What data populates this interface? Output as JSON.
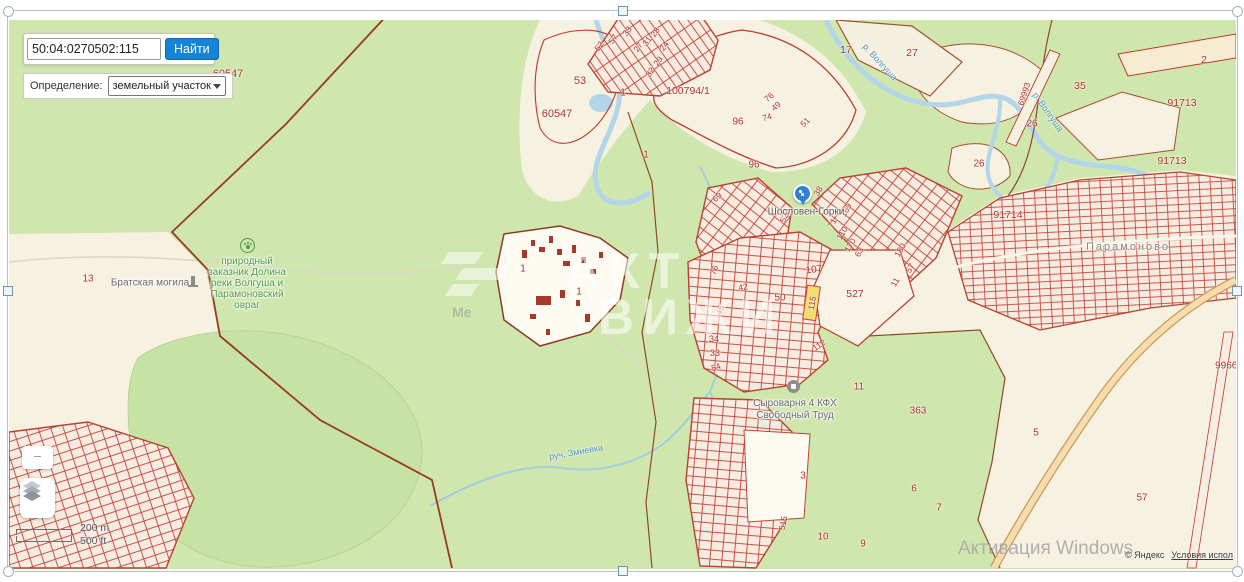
{
  "colors": {
    "accent_blue": "#1583d6",
    "parcel_red": "#b03227",
    "highlight_yellow": "#f1de6e",
    "map_green": "#cfe7ad"
  },
  "search_panel": {
    "query": "50:04:0270502:115",
    "find_button": "Найти",
    "definition_label": "Определение:",
    "definition_value": "земельный участок"
  },
  "map": {
    "watermark": {
      "line1": "АКТ",
      "line2": "ВИЖИ",
      "logo_text": "Ме"
    },
    "windows_activation": "Активация Windows",
    "attribution": "© Яндекс",
    "terms": "Условия испол",
    "scale": {
      "metric": "200 m",
      "imperial": "500 ft"
    },
    "highlight_label": "115",
    "poi": {
      "reserve": {
        "lines": [
          "природный",
          "заказник Долина",
          "реки Волгуша и",
          "Парамоновский",
          "овраг"
        ]
      },
      "memorial": {
        "text": "Братская могила"
      },
      "farm": {
        "line1": "Сыроварня 4 КФХ",
        "line2": "Свободный Труд"
      },
      "pin": {
        "text": "Шословен-Горки"
      },
      "village": {
        "text": "Парамоново"
      }
    },
    "river_labels": [
      {
        "t": "р. Волгуша",
        "x": 880,
        "y": 62,
        "r": 48
      },
      {
        "t": "р. Волгуша",
        "x": 1048,
        "y": 112,
        "r": 55
      },
      {
        "t": "руч. Змиевка",
        "x": 576,
        "y": 452,
        "r": -10
      }
    ],
    "parcel_labels": [
      {
        "t": "60547",
        "x": 228,
        "y": 74,
        "s": 11
      },
      {
        "t": "60547",
        "x": 557,
        "y": 114,
        "s": 11
      },
      {
        "t": "53",
        "x": 580,
        "y": 81,
        "s": 11
      },
      {
        "t": "1",
        "x": 623,
        "y": 93
      },
      {
        "t": "100794/1",
        "x": 688,
        "y": 91,
        "s": 10.5
      },
      {
        "t": "1",
        "x": 646,
        "y": 155
      },
      {
        "t": "96",
        "x": 738,
        "y": 122
      },
      {
        "t": "96",
        "x": 754,
        "y": 165
      },
      {
        "t": "52",
        "x": 599,
        "y": 46,
        "r": -55,
        "s": 8.5
      },
      {
        "t": "57",
        "x": 613,
        "y": 39,
        "r": -55,
        "s": 8.5
      },
      {
        "t": "33",
        "x": 627,
        "y": 31,
        "r": -55,
        "s": 8.5
      },
      {
        "t": "27",
        "x": 638,
        "y": 47,
        "r": -55,
        "s": 8.5
      },
      {
        "t": "31",
        "x": 647,
        "y": 41,
        "r": -55,
        "s": 8.5
      },
      {
        "t": "28",
        "x": 655,
        "y": 32,
        "r": -55,
        "s": 8.5
      },
      {
        "t": "24",
        "x": 664,
        "y": 46,
        "r": -55,
        "s": 8.5
      },
      {
        "t": "29",
        "x": 658,
        "y": 61,
        "r": -55,
        "s": 8.5
      },
      {
        "t": "32",
        "x": 650,
        "y": 72,
        "r": -55,
        "s": 8.5
      },
      {
        "t": "76",
        "x": 769,
        "y": 97,
        "r": -40,
        "s": 8.5
      },
      {
        "t": "49",
        "x": 776,
        "y": 106,
        "r": -40,
        "s": 8.5
      },
      {
        "t": "74",
        "x": 767,
        "y": 117,
        "r": -15,
        "s": 8.5
      },
      {
        "t": "51",
        "x": 805,
        "y": 122,
        "r": -45,
        "s": 8.5
      },
      {
        "t": "17",
        "x": 846,
        "y": 50,
        "s": 10.5
      },
      {
        "t": "27",
        "x": 912,
        "y": 53,
        "s": 10.5
      },
      {
        "t": "2",
        "x": 1204,
        "y": 60,
        "s": 10.5
      },
      {
        "t": "35",
        "x": 1080,
        "y": 86,
        "s": 10.5
      },
      {
        "t": "69993",
        "x": 1024,
        "y": 94,
        "r": -72,
        "s": 8.5
      },
      {
        "t": "26",
        "x": 1032,
        "y": 124
      },
      {
        "t": "26",
        "x": 979,
        "y": 164
      },
      {
        "t": "91713",
        "x": 1182,
        "y": 103,
        "s": 10.5
      },
      {
        "t": "91713",
        "x": 1172,
        "y": 161,
        "s": 10.5
      },
      {
        "t": "91714",
        "x": 1008,
        "y": 215,
        "s": 10.5
      },
      {
        "t": "69",
        "x": 717,
        "y": 197,
        "r": -45,
        "s": 8.5
      },
      {
        "t": "38",
        "x": 818,
        "y": 191,
        "r": -60,
        "s": 8.5
      },
      {
        "t": "52А",
        "x": 785,
        "y": 215,
        "r": -70,
        "s": 8.5
      },
      {
        "t": "169",
        "x": 846,
        "y": 210,
        "r": -60,
        "s": 8.5
      },
      {
        "t": "71",
        "x": 832,
        "y": 223,
        "r": -60,
        "s": 8.5
      },
      {
        "t": "110",
        "x": 842,
        "y": 233,
        "r": -60,
        "s": 8.5
      },
      {
        "t": "170",
        "x": 850,
        "y": 245,
        "r": -60,
        "s": 8.5
      },
      {
        "t": "63",
        "x": 859,
        "y": 252,
        "r": -60,
        "s": 8.5
      },
      {
        "t": "180",
        "x": 900,
        "y": 250,
        "r": -60,
        "s": 8.5
      },
      {
        "t": "57",
        "x": 910,
        "y": 268,
        "r": -60,
        "s": 8.5
      },
      {
        "t": "11",
        "x": 895,
        "y": 282,
        "r": -60,
        "s": 8.5
      },
      {
        "t": "107",
        "x": 814,
        "y": 270,
        "r": -8
      },
      {
        "t": "527",
        "x": 855,
        "y": 294,
        "s": 10.5
      },
      {
        "t": "76",
        "x": 714,
        "y": 270,
        "r": -70,
        "s": 8.5
      },
      {
        "t": "42",
        "x": 743,
        "y": 287,
        "r": -10,
        "s": 8.5
      },
      {
        "t": "50",
        "x": 780,
        "y": 298
      },
      {
        "t": "45",
        "x": 720,
        "y": 310,
        "r": -70,
        "s": 8.5
      },
      {
        "t": "34",
        "x": 714,
        "y": 339,
        "s": 9
      },
      {
        "t": "33",
        "x": 715,
        "y": 353,
        "s": 9
      },
      {
        "t": "112",
        "x": 819,
        "y": 345,
        "r": -35,
        "s": 8.5
      },
      {
        "t": "54",
        "x": 716,
        "y": 367,
        "r": -20,
        "s": 8.5
      },
      {
        "t": "515",
        "x": 783,
        "y": 523,
        "r": -78,
        "s": 8.5
      },
      {
        "t": "11",
        "x": 859,
        "y": 387
      },
      {
        "t": "363",
        "x": 918,
        "y": 411
      },
      {
        "t": "3",
        "x": 803,
        "y": 476
      },
      {
        "t": "6",
        "x": 914,
        "y": 489
      },
      {
        "t": "7",
        "x": 939,
        "y": 508
      },
      {
        "t": "10",
        "x": 823,
        "y": 537
      },
      {
        "t": "9",
        "x": 863,
        "y": 544
      },
      {
        "t": "5",
        "x": 1036,
        "y": 433
      },
      {
        "t": "57",
        "x": 1142,
        "y": 498
      },
      {
        "t": "99668",
        "x": 1229,
        "y": 366
      },
      {
        "t": "13",
        "x": 88,
        "y": 279
      },
      {
        "t": "1",
        "x": 523,
        "y": 269
      },
      {
        "t": "1",
        "x": 579,
        "y": 292
      },
      {
        "t": "115",
        "x": 812,
        "y": 303,
        "r": -80,
        "s": 8.5
      }
    ]
  }
}
